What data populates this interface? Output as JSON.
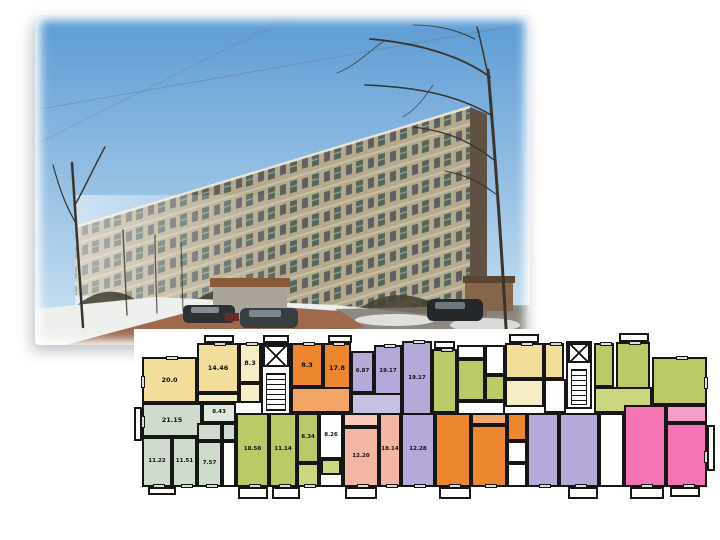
{
  "photo": {
    "subject": "nine-storey panel apartment building, winter, bare trees, parked cars, snow",
    "sky_top": "#5b9bd4",
    "sky_bottom": "#cfe4f3",
    "facade": "#b6aa8e",
    "facade_roofline": "#e9e3d3",
    "end_wall": "#5f5242",
    "bushes": "#44402f",
    "snow": "#eef0ee",
    "path": "#9d6a4e",
    "asphalt": "#7b756c",
    "shed_wall": "#aaa49a",
    "shed_roof": "#8a5a38",
    "car_body": "#2c3134",
    "tree": "#3a342c"
  },
  "floorplan": {
    "wall_color": "#161616",
    "areas_sqm": [
      "20.0",
      "14.46",
      "8.3",
      "8.3",
      "17.8",
      "6.87",
      "19.17",
      "19.17",
      "21.15",
      "8.43",
      "11.22",
      "11.51",
      "7.57",
      "18.58",
      "11.14",
      "8.34",
      "8.26",
      "12.20",
      "18.14",
      "12.28"
    ],
    "rooms": [
      {
        "n": "room-20-0",
        "label": "20.0",
        "x": 8,
        "y": 28,
        "w": 55,
        "h": 46,
        "color": "#F4DE9C",
        "win": "lt"
      },
      {
        "n": "room-14-46",
        "label": "14.46",
        "x": 63,
        "y": 14,
        "w": 42,
        "h": 50,
        "color": "#F4DE9C",
        "win": "t"
      },
      {
        "n": "room-8-3-a",
        "label": "8.3",
        "x": 105,
        "y": 14,
        "w": 22,
        "h": 40,
        "color": "#F8EEC6",
        "win": "t"
      },
      {
        "n": "hall",
        "x": 105,
        "y": 54,
        "w": 22,
        "h": 20,
        "color": "#F8EEC6"
      },
      {
        "n": "hall",
        "x": 63,
        "y": 64,
        "w": 42,
        "h": 10,
        "color": "#F8EEC6"
      },
      {
        "n": "room-8-3-b",
        "label": "8.3",
        "x": 157,
        "y": 14,
        "w": 32,
        "h": 44,
        "color": "#ED872F",
        "win": "t"
      },
      {
        "n": "room-17-8",
        "label": "17.8",
        "x": 189,
        "y": 14,
        "w": 28,
        "h": 50,
        "color": "#ED872F",
        "win": "t"
      },
      {
        "n": "hall",
        "x": 157,
        "y": 58,
        "w": 60,
        "h": 26,
        "color": "#F2A766"
      },
      {
        "n": "room-6-87",
        "label": "6.87",
        "fs": 5.5,
        "x": 217,
        "y": 22,
        "w": 23,
        "h": 42,
        "color": "#B4A9D8"
      },
      {
        "n": "room-19-17-a",
        "label": "19.17",
        "fs": 5.5,
        "x": 240,
        "y": 16,
        "w": 28,
        "h": 54,
        "color": "#B4A9D8",
        "win": "t"
      },
      {
        "n": "room-19-17-b",
        "label": "19.17",
        "fs": 5.5,
        "x": 268,
        "y": 12,
        "w": 30,
        "h": 76,
        "color": "#B4A9D8",
        "win": "t"
      },
      {
        "n": "hall",
        "x": 217,
        "y": 64,
        "w": 51,
        "h": 22,
        "color": "#C8BFE4"
      },
      {
        "n": "room-green",
        "x": 298,
        "y": 20,
        "w": 25,
        "h": 64,
        "color": "#BCC967",
        "win": "t"
      },
      {
        "n": "corridor",
        "x": 323,
        "y": 16,
        "w": 28,
        "h": 14,
        "color": "#FEFEFC"
      },
      {
        "n": "room-green",
        "x": 323,
        "y": 30,
        "w": 28,
        "h": 42,
        "color": "#BCC967"
      },
      {
        "n": "corridor",
        "x": 351,
        "y": 16,
        "w": 20,
        "h": 30,
        "color": "#FEFEFC"
      },
      {
        "n": "closet",
        "x": 351,
        "y": 46,
        "w": 20,
        "h": 26,
        "color": "#BCC967"
      },
      {
        "n": "corridor",
        "x": 323,
        "y": 72,
        "w": 48,
        "h": 14,
        "color": "#FEFEFC"
      },
      {
        "n": "room-yellow",
        "x": 371,
        "y": 14,
        "w": 39,
        "h": 36,
        "color": "#F4DE9C",
        "win": "t"
      },
      {
        "n": "room-yellow",
        "x": 410,
        "y": 14,
        "w": 20,
        "h": 36,
        "color": "#F4DE9C",
        "win": "t"
      },
      {
        "n": "hall",
        "x": 371,
        "y": 50,
        "w": 39,
        "h": 28,
        "color": "#F8EEC6"
      },
      {
        "n": "corridor",
        "x": 410,
        "y": 50,
        "w": 22,
        "h": 34,
        "color": "#FEFEFC"
      },
      {
        "n": "room-green",
        "x": 460,
        "y": 14,
        "w": 20,
        "h": 44,
        "color": "#BCC967",
        "win": "t"
      },
      {
        "n": "room-green",
        "x": 482,
        "y": 13,
        "w": 34,
        "h": 47,
        "color": "#BCC967",
        "win": "t"
      },
      {
        "n": "room-green-large",
        "x": 518,
        "y": 28,
        "w": 55,
        "h": 48,
        "color": "#BCC967",
        "win": "tr"
      },
      {
        "n": "hall",
        "x": 460,
        "y": 58,
        "w": 58,
        "h": 26,
        "color": "#CBD67E"
      },
      {
        "n": "room-21-15",
        "label": "21.15",
        "x": 8,
        "y": 74,
        "w": 60,
        "h": 34,
        "color": "#CFDCCD",
        "win": "l"
      },
      {
        "n": "room-11-22",
        "label": "11.22",
        "fs": 5.5,
        "x": 8,
        "y": 108,
        "w": 30,
        "h": 50,
        "color": "#CFDCCD",
        "win": "b"
      },
      {
        "n": "room-11-51",
        "label": "11.51",
        "fs": 5.5,
        "x": 38,
        "y": 108,
        "w": 25,
        "h": 50,
        "color": "#CFDCCD",
        "win": "b"
      },
      {
        "n": "room-7-57",
        "label": "7.57",
        "fs": 5.5,
        "x": 63,
        "y": 112,
        "w": 25,
        "h": 46,
        "color": "#CFDCCD",
        "win": "b"
      },
      {
        "n": "corridor-8-43",
        "label": "8.43",
        "fs": 5.5,
        "x": 68,
        "y": 74,
        "w": 34,
        "h": 20,
        "color": "#DFE9DC"
      },
      {
        "n": "bath",
        "x": 63,
        "y": 94,
        "w": 25,
        "h": 18,
        "color": "#CFDCCD"
      },
      {
        "n": "bath",
        "x": 88,
        "y": 94,
        "w": 14,
        "h": 18,
        "color": "#CFDCCD"
      },
      {
        "n": "corridor",
        "x": 88,
        "y": 112,
        "w": 14,
        "h": 46,
        "color": "#FEFEFC"
      },
      {
        "n": "room-18-58",
        "label": "18.58",
        "fs": 5.5,
        "x": 102,
        "y": 84,
        "w": 33,
        "h": 74,
        "color": "#BCC967",
        "win": "b"
      },
      {
        "n": "room-11-14",
        "label": "11.14",
        "fs": 5.5,
        "x": 135,
        "y": 84,
        "w": 28,
        "h": 74,
        "color": "#BCC967",
        "win": "b"
      },
      {
        "n": "room-8-34",
        "label": "8.34",
        "fs": 5.5,
        "x": 163,
        "y": 84,
        "w": 22,
        "h": 50,
        "color": "#BCC967"
      },
      {
        "n": "hall",
        "x": 163,
        "y": 134,
        "w": 22,
        "h": 24,
        "color": "#CBD67E",
        "win": "b"
      },
      {
        "n": "room-8-26",
        "label": "8.26",
        "fs": 5.5,
        "x": 185,
        "y": 84,
        "w": 24,
        "h": 46,
        "color": "#FEFEFC"
      },
      {
        "n": "corridor",
        "x": 185,
        "y": 130,
        "w": 24,
        "h": 28,
        "color": "#FEFEFC"
      },
      {
        "n": "closet",
        "x": 187,
        "y": 130,
        "w": 20,
        "h": 16,
        "color": "#CBD67E"
      },
      {
        "n": "hall",
        "x": 209,
        "y": 84,
        "w": 36,
        "h": 14,
        "color": "#F8C9BC"
      },
      {
        "n": "room-12-20",
        "label": "12.20",
        "fs": 5.5,
        "x": 209,
        "y": 98,
        "w": 36,
        "h": 60,
        "color": "#F5B5A5",
        "win": "b"
      },
      {
        "n": "room-18-14",
        "label": "18.14",
        "fs": 5.5,
        "x": 245,
        "y": 84,
        "w": 22,
        "h": 74,
        "color": "#F5B5A5",
        "win": "b"
      },
      {
        "n": "room-12-28",
        "label": "12.28",
        "fs": 5.5,
        "x": 267,
        "y": 84,
        "w": 34,
        "h": 74,
        "color": "#B4A9D8",
        "win": "b"
      },
      {
        "n": "room-orange",
        "x": 301,
        "y": 84,
        "w": 36,
        "h": 74,
        "color": "#ED872F",
        "win": "b"
      },
      {
        "n": "hall",
        "x": 337,
        "y": 84,
        "w": 36,
        "h": 12,
        "color": "#F2A766"
      },
      {
        "n": "room-orange",
        "x": 337,
        "y": 96,
        "w": 36,
        "h": 62,
        "color": "#ED872F",
        "win": "b"
      },
      {
        "n": "room-orange",
        "x": 373,
        "y": 84,
        "w": 20,
        "h": 28,
        "color": "#ED872F"
      },
      {
        "n": "bath",
        "x": 373,
        "y": 112,
        "w": 20,
        "h": 22,
        "color": "#FEFEFC"
      },
      {
        "n": "corridor",
        "x": 373,
        "y": 134,
        "w": 20,
        "h": 24,
        "color": "#FEFEFC"
      },
      {
        "n": "room-lavender",
        "x": 393,
        "y": 84,
        "w": 32,
        "h": 74,
        "color": "#B4A9D8",
        "win": "b"
      },
      {
        "n": "room-lavender",
        "x": 425,
        "y": 84,
        "w": 40,
        "h": 74,
        "color": "#B4A9D8",
        "win": "b"
      },
      {
        "n": "corridor",
        "x": 465,
        "y": 84,
        "w": 25,
        "h": 74,
        "color": "#FEFEFC"
      },
      {
        "n": "room-pink",
        "x": 490,
        "y": 76,
        "w": 42,
        "h": 82,
        "color": "#F473B2",
        "win": "b"
      },
      {
        "n": "hall",
        "x": 532,
        "y": 76,
        "w": 41,
        "h": 18,
        "color": "#F79BC8"
      },
      {
        "n": "room-pink",
        "x": 532,
        "y": 94,
        "w": 41,
        "h": 64,
        "color": "#F473B2",
        "win": "br"
      }
    ],
    "balconies": [
      {
        "x": 70,
        "y": 6,
        "w": 30,
        "h": 8
      },
      {
        "x": 129,
        "y": 6,
        "w": 26,
        "h": 8
      },
      {
        "x": 194,
        "y": 6,
        "w": 24,
        "h": 8
      },
      {
        "x": 300,
        "y": 12,
        "w": 21,
        "h": 8
      },
      {
        "x": 375,
        "y": 5,
        "w": 30,
        "h": 9
      },
      {
        "x": 485,
        "y": 4,
        "w": 30,
        "h": 9
      },
      {
        "x": 14,
        "y": 158,
        "w": 28,
        "h": 8
      },
      {
        "x": 104,
        "y": 158,
        "w": 30,
        "h": 12
      },
      {
        "x": 138,
        "y": 158,
        "w": 28,
        "h": 12
      },
      {
        "x": 211,
        "y": 158,
        "w": 32,
        "h": 12
      },
      {
        "x": 305,
        "y": 158,
        "w": 32,
        "h": 12
      },
      {
        "x": 434,
        "y": 158,
        "w": 30,
        "h": 12
      },
      {
        "x": 496,
        "y": 158,
        "w": 34,
        "h": 12
      },
      {
        "x": 536,
        "y": 158,
        "w": 30,
        "h": 10
      },
      {
        "x": 573,
        "y": 96,
        "w": 8,
        "h": 46
      },
      {
        "x": 0,
        "y": 78,
        "w": 8,
        "h": 34
      }
    ],
    "stairwells": [
      {
        "x": 127,
        "y": 14,
        "w": 30,
        "h": 72,
        "elev": {
          "x": 129,
          "y": 16,
          "w": 26,
          "h": 22
        },
        "stairs": {
          "x": 132,
          "y": 44,
          "w": 20,
          "h": 38
        }
      },
      {
        "x": 432,
        "y": 12,
        "w": 26,
        "h": 68,
        "elev": {
          "x": 434,
          "y": 14,
          "w": 22,
          "h": 20
        },
        "stairs": {
          "x": 437,
          "y": 40,
          "w": 16,
          "h": 36
        }
      }
    ]
  }
}
